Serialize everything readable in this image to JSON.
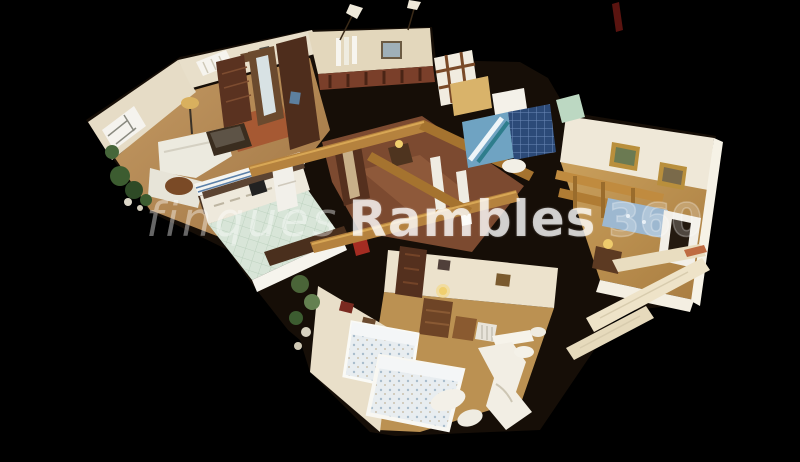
{
  "app": {
    "type": "virtual-tour-dollhouse-view",
    "background_color": "#000000"
  },
  "watermark": {
    "prefix": "finques",
    "brand": "Rambles",
    "suffix": "360"
  },
  "palette": {
    "wall_cream": "#e8dcc2",
    "wall_bright_cut": "#f7f4ea",
    "wood_floor": "#b5854d",
    "hall_tile_red": "#7c4a30",
    "beam_gold": "#b5823e",
    "kitchen_floor_mint": "#d8e5d8",
    "kitchen_stripe_blue": "#5a7fa8",
    "bath_tile_blue": "#6fa3c2",
    "bath_tile_dark_blue": "#2c4a78",
    "bedding_pale_blue": "#e7ecef",
    "mattress_blue": "#9db8d0",
    "picture_frame_gold": "#b98f3c",
    "dark_wood": "#54301e",
    "plant_green": "#3c5c30",
    "lamp_yellow": "#f0cf6e",
    "balcony_plank_cream": "#eadfc4",
    "rug_red": "#a4512e"
  },
  "scene": {
    "rooms": [
      "living-room",
      "kitchen",
      "hallway",
      "gallery-tower",
      "bathroom-blue",
      "bedroom-right",
      "bedroom-bottom",
      "bathroom-white",
      "balcony-fragments"
    ]
  }
}
